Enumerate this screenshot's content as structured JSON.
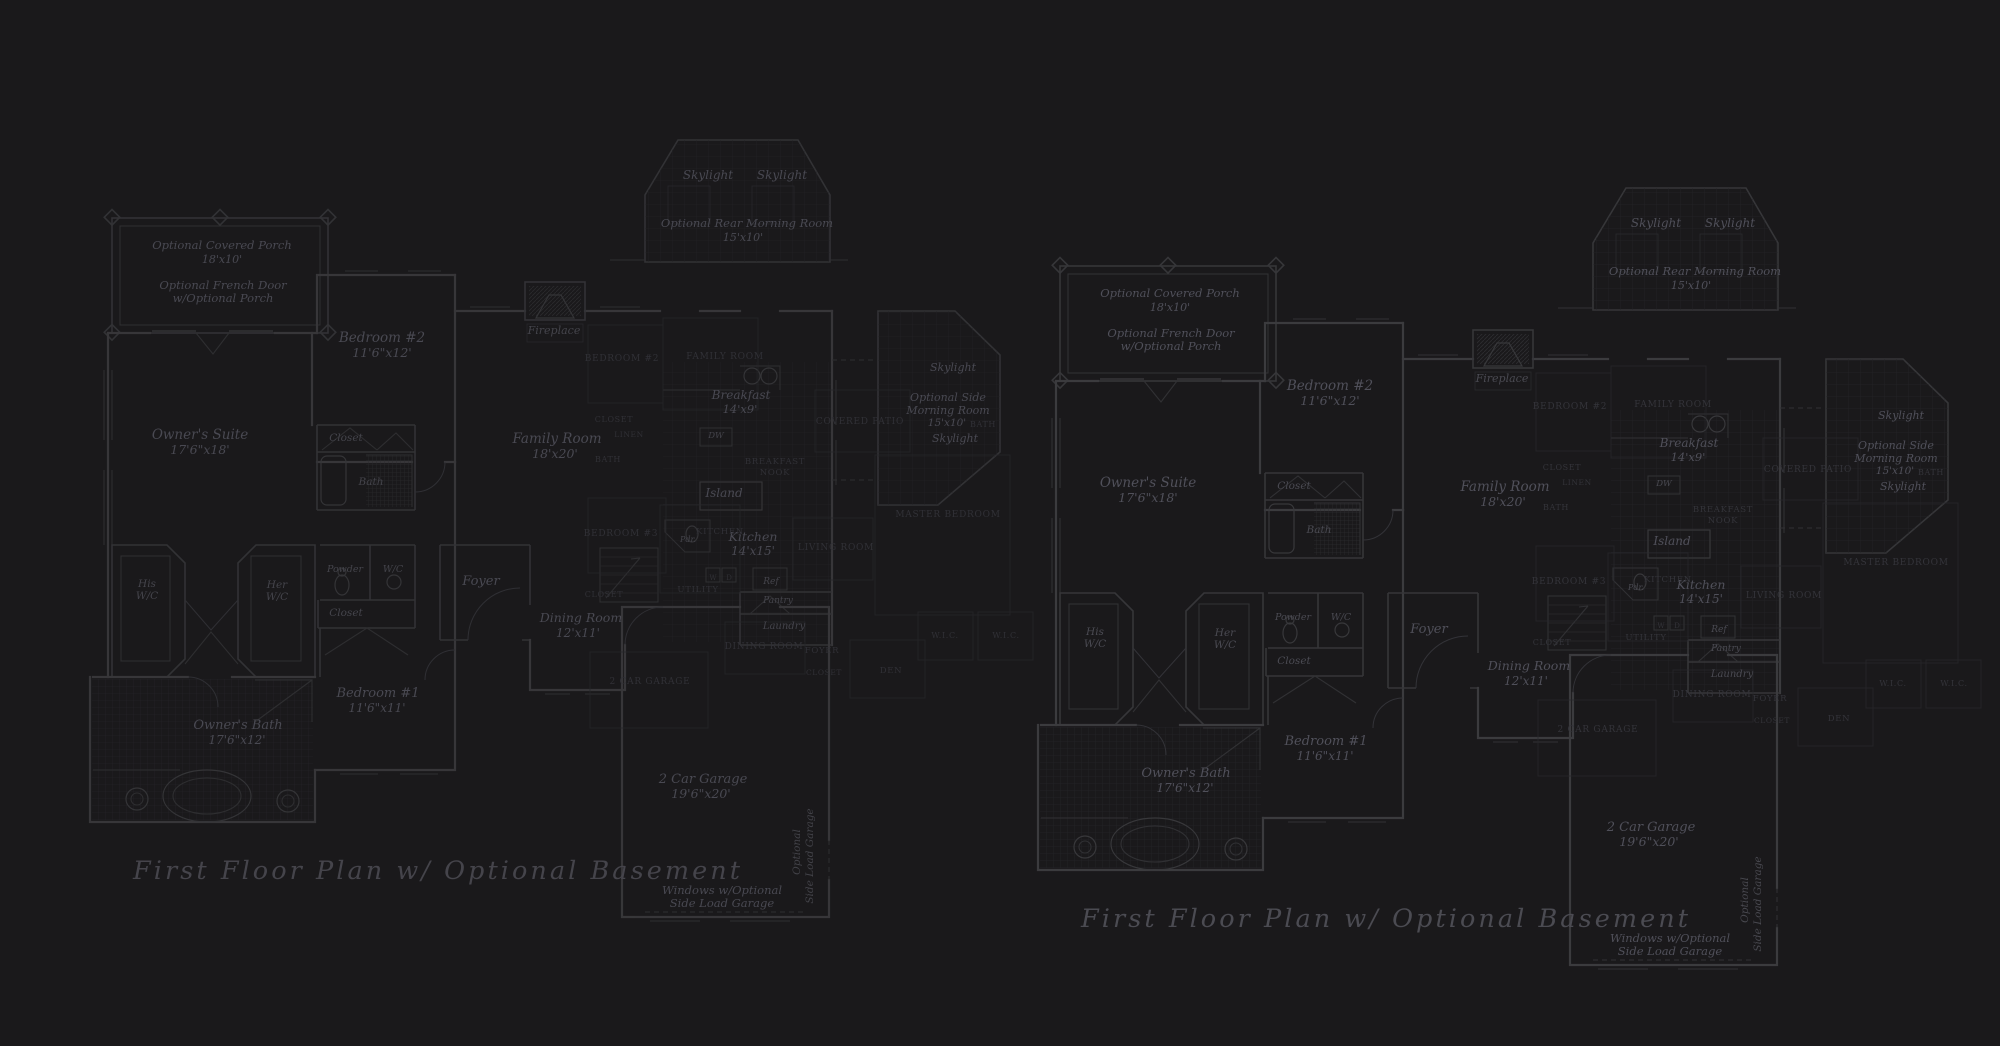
{
  "page": {
    "background_color": "#1a191b",
    "wall_color": "#3b3b3e",
    "label_color": "#50505a",
    "underlay_label_color": "#34343a",
    "description_title": "First Floor Plan  w/ Optional Basement"
  },
  "plan": {
    "title": "First Floor Plan  w/ Optional Basement",
    "labels": [
      {
        "id": "porch-name",
        "t": "Optional Covered Porch",
        "x": 222,
        "y": 249,
        "s": 11.5,
        "k": "room"
      },
      {
        "id": "porch-dim",
        "t": "18'x10'",
        "x": 222,
        "y": 263,
        "s": 11,
        "k": "room"
      },
      {
        "id": "frenchdoor-1",
        "t": "Optional French Door",
        "x": 223,
        "y": 289,
        "s": 11.5,
        "k": "room"
      },
      {
        "id": "frenchdoor-2",
        "t": "w/Optional Porch",
        "x": 223,
        "y": 302,
        "s": 11.5,
        "k": "room"
      },
      {
        "id": "bedroom2-name",
        "t": "Bedroom #2",
        "x": 382,
        "y": 342,
        "s": 13.5,
        "k": "room"
      },
      {
        "id": "bedroom2-dim",
        "t": "11'6\"x12'",
        "x": 382,
        "y": 357,
        "s": 12.5,
        "k": "room"
      },
      {
        "id": "owners-suite-name",
        "t": "Owner's Suite",
        "x": 200,
        "y": 439,
        "s": 13.5,
        "k": "room"
      },
      {
        "id": "owners-suite-dim",
        "t": "17'6\"x18'",
        "x": 200,
        "y": 454,
        "s": 12.5,
        "k": "room"
      },
      {
        "id": "closet-upper",
        "t": "Closet",
        "x": 346,
        "y": 441,
        "s": 10.5,
        "k": "small"
      },
      {
        "id": "bath",
        "t": "Bath",
        "x": 371,
        "y": 485,
        "s": 10.5,
        "k": "small"
      },
      {
        "id": "his-wc-1",
        "t": "His",
        "x": 147,
        "y": 587,
        "s": 10.5,
        "k": "small"
      },
      {
        "id": "his-wc-2",
        "t": "W/C",
        "x": 147,
        "y": 599,
        "s": 10.5,
        "k": "small"
      },
      {
        "id": "her-wc-1",
        "t": "Her",
        "x": 277,
        "y": 588,
        "s": 10.5,
        "k": "small"
      },
      {
        "id": "her-wc-2",
        "t": "W/C",
        "x": 277,
        "y": 600,
        "s": 10.5,
        "k": "small"
      },
      {
        "id": "powder",
        "t": "Powder",
        "x": 345,
        "y": 572,
        "s": 9.5,
        "k": "small"
      },
      {
        "id": "wc",
        "t": "W/C",
        "x": 393,
        "y": 572,
        "s": 9.5,
        "k": "small"
      },
      {
        "id": "closet-mid",
        "t": "Closet",
        "x": 346,
        "y": 616,
        "s": 10.5,
        "k": "small"
      },
      {
        "id": "bedroom1-name",
        "t": "Bedroom #1",
        "x": 378,
        "y": 697,
        "s": 13,
        "k": "room"
      },
      {
        "id": "bedroom1-dim",
        "t": "11'6\"x11'",
        "x": 377,
        "y": 712,
        "s": 12,
        "k": "room"
      },
      {
        "id": "owners-bath-name",
        "t": "Owner's Bath",
        "x": 238,
        "y": 729,
        "s": 13,
        "k": "room"
      },
      {
        "id": "owners-bath-dim",
        "t": "17'6\"x12'",
        "x": 237,
        "y": 744,
        "s": 12,
        "k": "room"
      },
      {
        "id": "fireplace",
        "t": "Fireplace",
        "x": 554,
        "y": 334,
        "s": 11,
        "k": "small"
      },
      {
        "id": "skylight-rear-1",
        "t": "Skylight",
        "x": 708,
        "y": 179,
        "s": 12,
        "k": "room"
      },
      {
        "id": "skylight-rear-2",
        "t": "Skylight",
        "x": 782,
        "y": 179,
        "s": 12,
        "k": "room"
      },
      {
        "id": "rear-morning-name",
        "t": "Optional Rear Morning Room",
        "x": 747,
        "y": 227,
        "s": 11.5,
        "k": "room"
      },
      {
        "id": "rear-morning-dim",
        "t": "15'x10'",
        "x": 743,
        "y": 241,
        "s": 11,
        "k": "room"
      },
      {
        "id": "family-room-name",
        "t": "Family Room",
        "x": 557,
        "y": 443,
        "s": 13.5,
        "k": "room"
      },
      {
        "id": "family-room-dim",
        "t": "18'x20'",
        "x": 555,
        "y": 458,
        "s": 12.5,
        "k": "room"
      },
      {
        "id": "foyer",
        "t": "Foyer",
        "x": 481,
        "y": 585,
        "s": 13,
        "k": "room"
      },
      {
        "id": "dining-name",
        "t": "Dining Room",
        "x": 581,
        "y": 622,
        "s": 12.5,
        "k": "room"
      },
      {
        "id": "dining-dim",
        "t": "12'x11'",
        "x": 578,
        "y": 637,
        "s": 12,
        "k": "room"
      },
      {
        "id": "breakfast-name",
        "t": "Breakfast",
        "x": 741,
        "y": 399,
        "s": 12,
        "k": "room"
      },
      {
        "id": "breakfast-dim",
        "t": "14'x9'",
        "x": 740,
        "y": 413,
        "s": 11.5,
        "k": "room"
      },
      {
        "id": "dw",
        "t": "DW",
        "x": 716,
        "y": 438,
        "s": 8.5,
        "k": "small"
      },
      {
        "id": "island",
        "t": "Island",
        "x": 724,
        "y": 497,
        "s": 12,
        "k": "room"
      },
      {
        "id": "kitchen-name",
        "t": "Kitchen",
        "x": 753,
        "y": 541,
        "s": 12.5,
        "k": "room"
      },
      {
        "id": "kitchen-dim",
        "t": "14'x15'",
        "x": 753,
        "y": 555,
        "s": 12,
        "k": "room"
      },
      {
        "id": "ref",
        "t": "Ref",
        "x": 771,
        "y": 584,
        "s": 9,
        "k": "small"
      },
      {
        "id": "pantry",
        "t": "Pantry",
        "x": 778,
        "y": 603,
        "s": 9,
        "k": "small"
      },
      {
        "id": "laundry",
        "t": "Laundry",
        "x": 784,
        "y": 629,
        "s": 10,
        "k": "small"
      },
      {
        "id": "pdr",
        "t": "Pdr.",
        "x": 688,
        "y": 542,
        "s": 8,
        "k": "small"
      },
      {
        "id": "garage-name",
        "t": "2 Car Garage",
        "x": 703,
        "y": 783,
        "s": 13,
        "k": "room"
      },
      {
        "id": "garage-dim",
        "t": "19'6\"x20'",
        "x": 701,
        "y": 798,
        "s": 12.5,
        "k": "room"
      },
      {
        "id": "sideload-vert-1",
        "t": "Optional",
        "x": 800,
        "y": 852,
        "s": 10.5,
        "k": "vert",
        "r": -90
      },
      {
        "id": "sideload-vert-2",
        "t": "Side Load Garage",
        "x": 813,
        "y": 856,
        "s": 10.5,
        "k": "vert",
        "r": -90
      },
      {
        "id": "windows-note-1",
        "t": "Windows w/Optional",
        "x": 722,
        "y": 894,
        "s": 11.5,
        "k": "room"
      },
      {
        "id": "windows-note-2",
        "t": "Side Load Garage",
        "x": 722,
        "y": 907,
        "s": 11.5,
        "k": "room"
      },
      {
        "id": "side-skylight-1",
        "t": "Skylight",
        "x": 953,
        "y": 371,
        "s": 11,
        "k": "room"
      },
      {
        "id": "side-morning-1",
        "t": "Optional Side",
        "x": 948,
        "y": 401,
        "s": 11,
        "k": "room"
      },
      {
        "id": "side-morning-2",
        "t": "Morning Room",
        "x": 948,
        "y": 414,
        "s": 11,
        "k": "room"
      },
      {
        "id": "side-morning-dim",
        "t": "15'x10'",
        "x": 947,
        "y": 426,
        "s": 10.5,
        "k": "room"
      },
      {
        "id": "side-skylight-2",
        "t": "Skylight",
        "x": 955,
        "y": 442,
        "s": 11,
        "k": "room"
      },
      {
        "id": "plan-title",
        "t": "First Floor Plan  w/ Optional Basement",
        "x": 133,
        "y": 879,
        "s": 25.5,
        "k": "title",
        "a": "start"
      },
      {
        "id": "u-family-room",
        "t": "FAMILY ROOM",
        "x": 725,
        "y": 359,
        "s": 9,
        "k": "caps"
      },
      {
        "id": "u-bedroom2",
        "t": "BEDROOM #2",
        "x": 622,
        "y": 361,
        "s": 9,
        "k": "caps"
      },
      {
        "id": "u-closet-1",
        "t": "CLOSET",
        "x": 614,
        "y": 422,
        "s": 8,
        "k": "caps"
      },
      {
        "id": "u-linen",
        "t": "LINEN",
        "x": 629,
        "y": 437,
        "s": 7.5,
        "k": "caps"
      },
      {
        "id": "u-bath-1",
        "t": "BATH",
        "x": 608,
        "y": 462,
        "s": 8,
        "k": "caps"
      },
      {
        "id": "u-breakfast",
        "t": "BREAKFAST",
        "x": 775,
        "y": 464,
        "s": 8.5,
        "k": "caps"
      },
      {
        "id": "u-nook",
        "t": "NOOK",
        "x": 775,
        "y": 475,
        "s": 8.5,
        "k": "caps"
      },
      {
        "id": "u-bedroom3",
        "t": "BEDROOM #3",
        "x": 621,
        "y": 536,
        "s": 9,
        "k": "caps"
      },
      {
        "id": "u-kitchen",
        "t": "KITCHEN",
        "x": 720,
        "y": 534,
        "s": 8.5,
        "k": "caps"
      },
      {
        "id": "u-utility",
        "t": "UTILITY",
        "x": 698,
        "y": 592,
        "s": 8.5,
        "k": "caps"
      },
      {
        "id": "u-closet-2",
        "t": "CLOSET",
        "x": 604,
        "y": 597,
        "s": 8,
        "k": "caps"
      },
      {
        "id": "u-dining",
        "t": "DINING ROOM",
        "x": 764,
        "y": 649,
        "s": 9,
        "k": "caps"
      },
      {
        "id": "u-foyer",
        "t": "FOYER",
        "x": 822,
        "y": 653,
        "s": 8.5,
        "k": "caps"
      },
      {
        "id": "u-garage",
        "t": "2 CAR GARAGE",
        "x": 650,
        "y": 684,
        "s": 9,
        "k": "caps"
      },
      {
        "id": "u-covered-patio",
        "t": "COVERED PATIO",
        "x": 860,
        "y": 424,
        "s": 9,
        "k": "caps"
      },
      {
        "id": "u-bath-2",
        "t": "BATH",
        "x": 983,
        "y": 427,
        "s": 8,
        "k": "caps"
      },
      {
        "id": "u-master-bedroom",
        "t": "MASTER BEDROOM",
        "x": 948,
        "y": 517,
        "s": 9,
        "k": "caps"
      },
      {
        "id": "u-living-room",
        "t": "LIVING ROOM",
        "x": 836,
        "y": 550,
        "s": 9,
        "k": "caps"
      },
      {
        "id": "u-wic-1",
        "t": "W.I.C.",
        "x": 945,
        "y": 638,
        "s": 8,
        "k": "caps"
      },
      {
        "id": "u-wic-2",
        "t": "W.I.C.",
        "x": 1006,
        "y": 638,
        "s": 8,
        "k": "caps"
      },
      {
        "id": "u-den",
        "t": "DEN",
        "x": 891,
        "y": 673,
        "s": 8.5,
        "k": "caps"
      },
      {
        "id": "u-closet-3",
        "t": "CLOSET",
        "x": 824,
        "y": 675,
        "s": 7.5,
        "k": "caps"
      },
      {
        "id": "u-washer",
        "t": "W",
        "x": 713,
        "y": 580,
        "s": 7,
        "k": "capstiny"
      },
      {
        "id": "u-dryer",
        "t": "D",
        "x": 729,
        "y": 580,
        "s": 7,
        "k": "capstiny"
      }
    ],
    "copies": [
      {
        "id": "plan-left",
        "dx": 0,
        "dy": 0,
        "opacity": 0.88
      },
      {
        "id": "plan-right",
        "dx": 948,
        "dy": 48,
        "opacity": 1
      }
    ]
  }
}
